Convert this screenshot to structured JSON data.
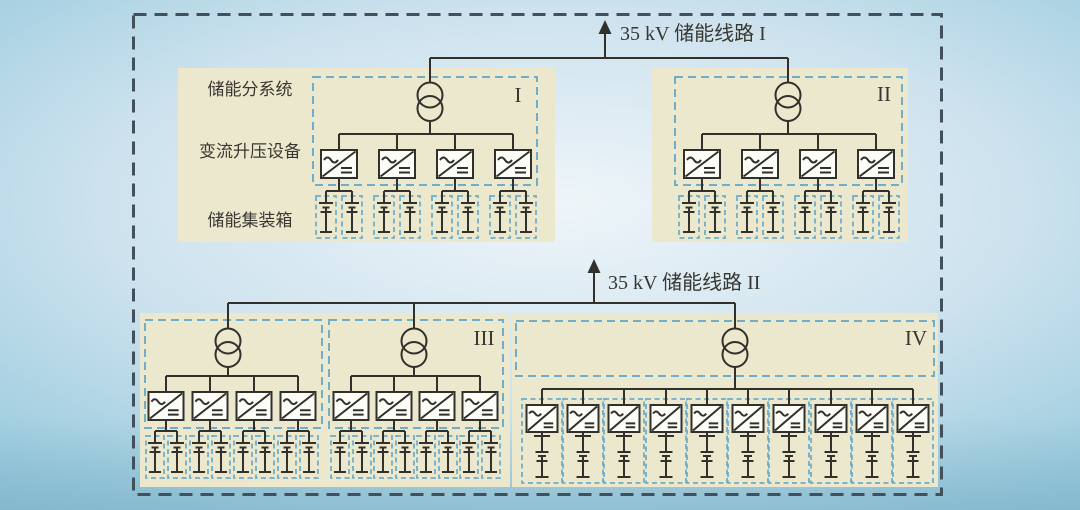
{
  "colors": {
    "bg_center": "#eef5f9",
    "bg_mid": "#cde2ee",
    "bg_edge": "#9ecddf",
    "bg_bottom": "#8cc0d6",
    "panel": "#ebe8ce",
    "dashed_blue": "#6fadc9",
    "outer_border": "#42505c",
    "line": "#32302b",
    "text": "#393731",
    "symbol_fill": "#fdfdf8"
  },
  "labels": {
    "feeder1": "35 kV 储能线路 I",
    "feeder2": "35 kV 储能线路 II",
    "row1": "储能分系统",
    "row2": "变流升压设备",
    "row3": "储能集装箱",
    "numeral1": "I",
    "numeral2": "II",
    "numeral3": "III",
    "numeral4": "IV"
  },
  "diagram": {
    "outer_box": [
      133.5,
      14.5,
      808,
      480
    ],
    "transformer": {
      "radius": 12.5,
      "offset": 13.5
    },
    "feeders": [
      {
        "name": "feeder-line-1",
        "bus_y": 58,
        "bus_x1": 430,
        "bus_x2": 788,
        "arrow_x": 605,
        "arrow_tip_y": 20
      },
      {
        "name": "feeder-line-2",
        "bus_y": 303,
        "bus_x1": 228,
        "bus_x2": 735,
        "arrow_x": 594,
        "arrow_tip_y": 259
      }
    ],
    "blocks": [
      {
        "name": "subsystem-I",
        "panel": [
          178,
          68,
          377,
          174
        ],
        "groups": [
          {
            "feeder": 0,
            "dashed_box": [
              313,
              77,
              224,
              108
            ],
            "tx": 430,
            "ty": 95,
            "conv_bus_y": 134,
            "conv_top": 150,
            "conv_w": 36,
            "conv_h": 28,
            "converters": [
              339,
              397,
              455,
              513
            ]
          }
        ],
        "battery": {
          "mode": "pair",
          "offset": 13,
          "split_y": 191,
          "box_top": 196,
          "box_w": 20,
          "box_h": 42
        }
      },
      {
        "name": "subsystem-II",
        "panel": [
          652,
          68,
          256,
          174
        ],
        "groups": [
          {
            "feeder": 0,
            "dashed_box": [
              675,
              77,
              227,
              108
            ],
            "tx": 788,
            "ty": 95,
            "conv_bus_y": 134,
            "conv_top": 150,
            "conv_w": 36,
            "conv_h": 28,
            "converters": [
              702,
              760,
              818,
              876
            ]
          }
        ],
        "battery": {
          "mode": "pair",
          "offset": 13,
          "split_y": 191,
          "box_top": 196,
          "box_w": 20,
          "box_h": 42
        }
      },
      {
        "name": "subsystem-III",
        "panel": [
          140,
          313,
          370,
          174
        ],
        "groups": [
          {
            "feeder": 1,
            "dashed_box": [
              145,
              320,
              177,
              108
            ],
            "tx": 228,
            "ty": 341,
            "conv_bus_y": 376,
            "conv_top": 392,
            "conv_w": 35,
            "conv_h": 28,
            "converters": [
              166,
              210,
              254,
              298
            ]
          },
          {
            "feeder": 1,
            "dashed_box": [
              329,
              320,
              174,
              108
            ],
            "tx": 414,
            "ty": 341,
            "conv_bus_y": 376,
            "conv_top": 392,
            "conv_w": 35,
            "conv_h": 28,
            "converters": [
              351,
              394,
              437,
              480
            ]
          }
        ],
        "battery": {
          "mode": "pair",
          "offset": 11,
          "split_y": 431,
          "box_top": 436,
          "box_w": 18,
          "box_h": 42
        }
      },
      {
        "name": "subsystem-IV",
        "panel": [
          512,
          313,
          426,
          174
        ],
        "groups": [
          {
            "feeder": 1,
            "dashed_box": [
              516,
              321,
              418,
              55
            ],
            "tx": 735,
            "ty": 341,
            "conv_bus_y": 389,
            "conv_top": 405,
            "conv_w": 31,
            "conv_h": 27,
            "converters": [
              542,
              583,
              624,
              666,
              707,
              748,
              789,
              831,
              872,
              913
            ]
          }
        ],
        "battery": {
          "mode": "single",
          "col_box_top": 399,
          "col_w": 40,
          "col_h": 84
        }
      }
    ]
  }
}
